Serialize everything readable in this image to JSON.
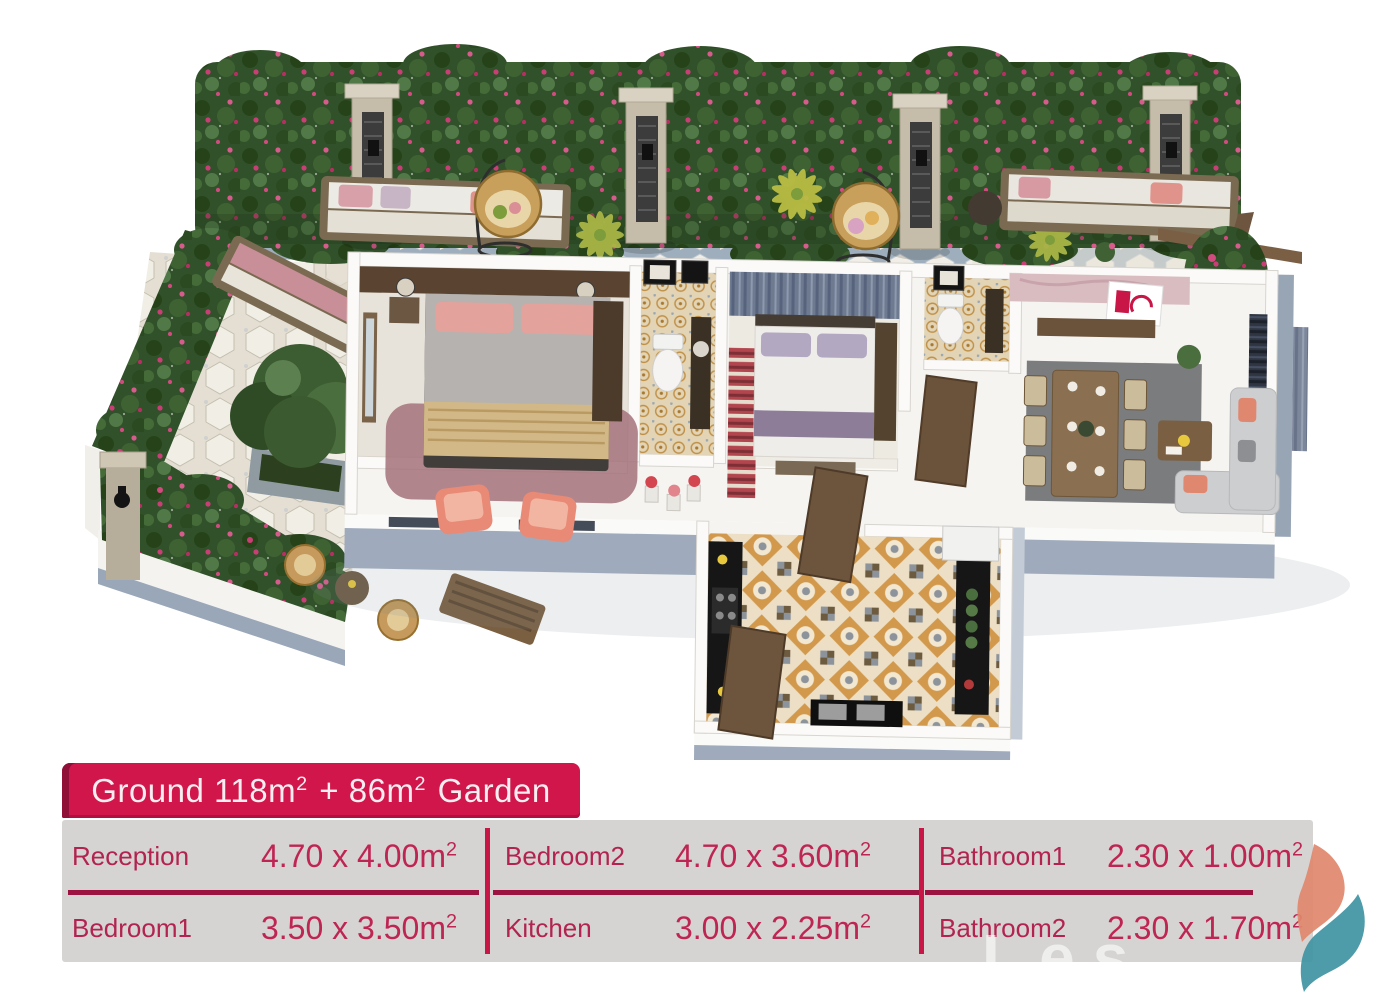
{
  "title": {
    "t1": "Ground 118m",
    "s1": "2",
    "t2": " + 86m",
    "s2": "2",
    "t3": " Garden"
  },
  "rooms": [
    {
      "label": "Reception",
      "dims": "4.70 x 4.00m",
      "sup": "2"
    },
    {
      "label": "Bedroom1",
      "dims": "3.50 x 3.50m",
      "sup": "2"
    },
    {
      "label": "Bedroom2",
      "dims": "4.70 x 3.60m",
      "sup": "2"
    },
    {
      "label": "Kitchen",
      "dims": "3.00 x 2.25m",
      "sup": "2"
    },
    {
      "label": "Bathroom1",
      "dims": "2.30 x 1.00m",
      "sup": "2"
    },
    {
      "label": "Bathroom2",
      "dims": "2.30 x 1.70m",
      "sup": "2"
    }
  ],
  "watermark": "Les",
  "colors": {
    "accent": "#d0164a",
    "accent_dark": "#8f0f38",
    "divider": "#9c1240",
    "divider_vertical": "#c81747",
    "panel_gray": "#d5d4d2",
    "room_text": "#b22350",
    "logo_orange": "#e0876b",
    "logo_teal": "#3f93a3",
    "hedge_green": "#31512a",
    "flower_pink": "#c93e74",
    "wall_cap_gray": "#9aa7b8"
  }
}
